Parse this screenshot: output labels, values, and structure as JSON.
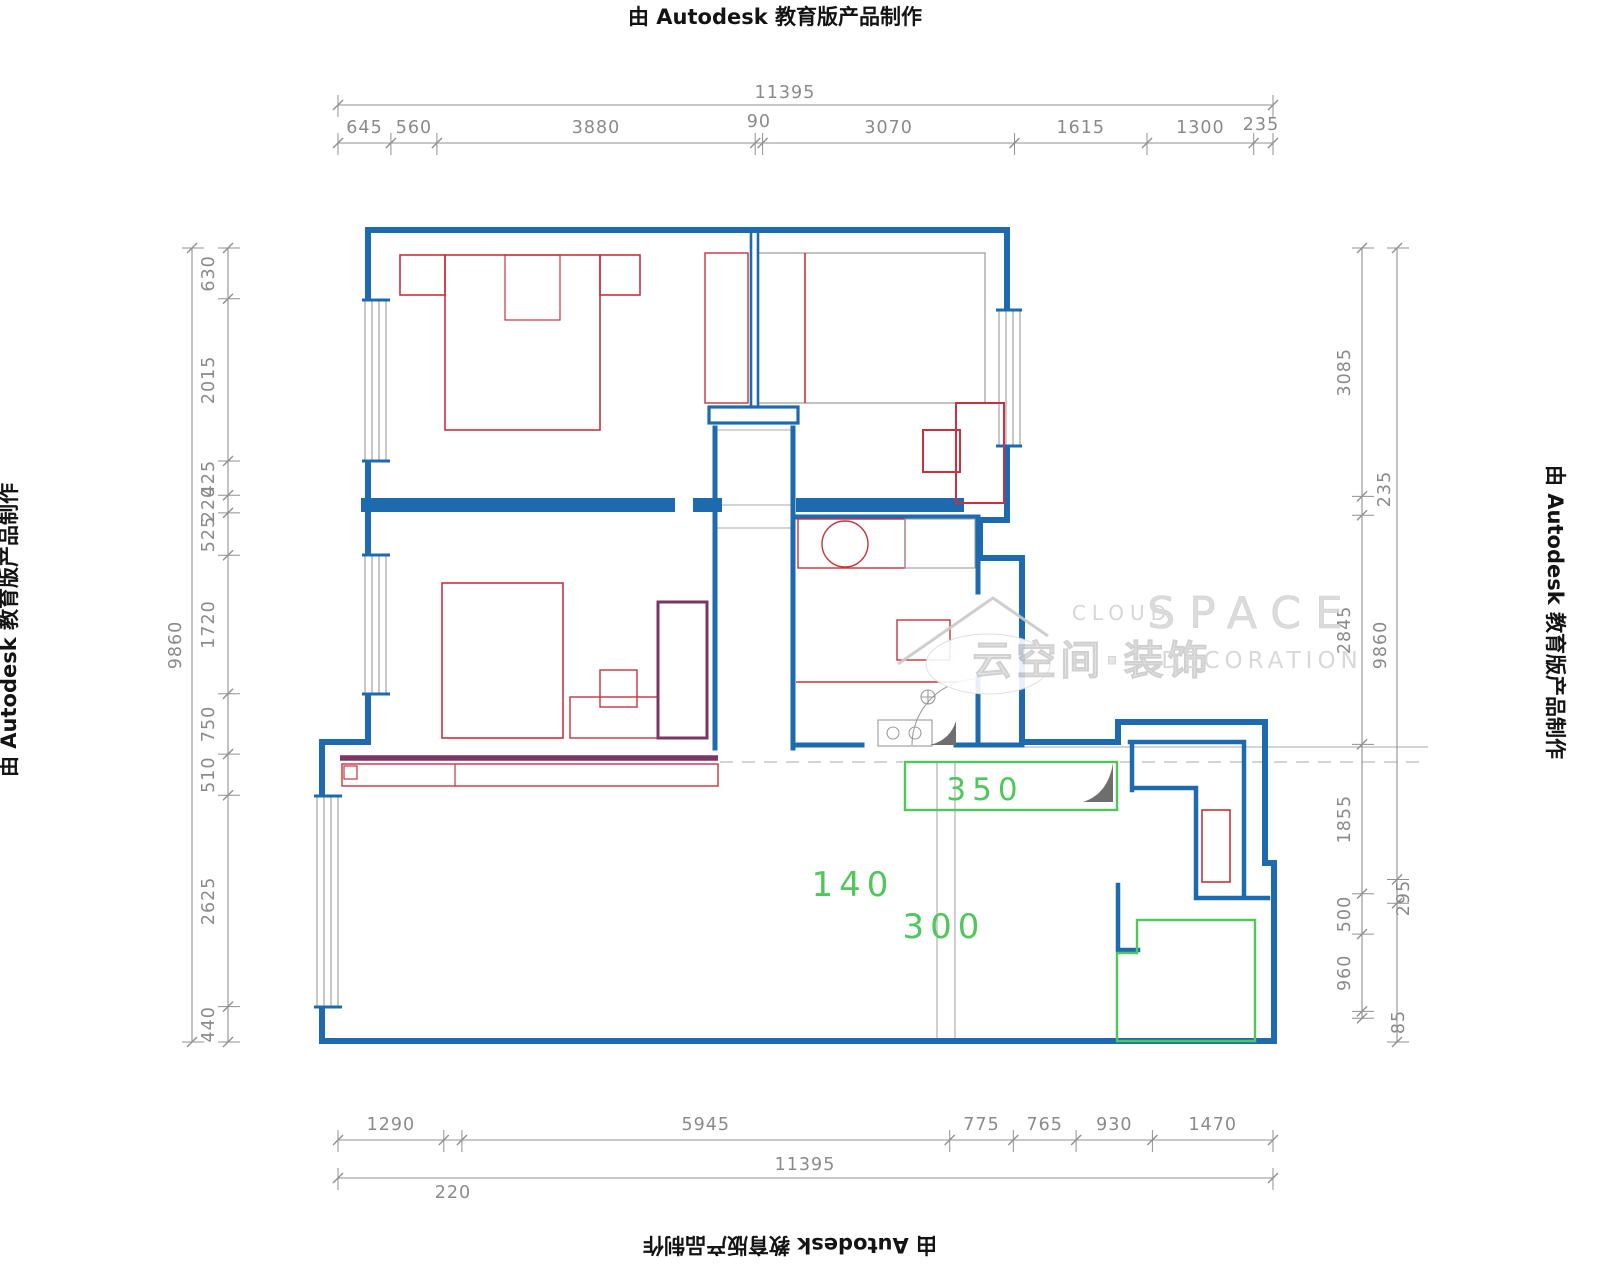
{
  "watermark": {
    "autodesk": "由 Autodesk 教育版产品制作",
    "logo_cloud": "CLOUD",
    "logo_space": "SPACE",
    "logo_cn": "云空间·装饰",
    "logo_decoration": "DECORATION"
  },
  "colors": {
    "wall_blue": "#1d6aae",
    "furniture_red": "#c8323e",
    "wardrobe_purple": "#7d3563",
    "green": "#4fc75a",
    "dim_gray": "#909090",
    "aux_gray": "#a8a8a8",
    "door_fill": "#6e6e6e",
    "watermark_gray": "#d6d6d6"
  },
  "annotations": {
    "green_labels": [
      {
        "t": "350",
        "x": 985,
        "y": 800,
        "size": 31
      },
      {
        "t": "140",
        "x": 853,
        "y": 896,
        "size": 34
      },
      {
        "t": "300",
        "x": 944,
        "y": 938,
        "size": 34
      }
    ]
  },
  "dims": {
    "rows": [
      {
        "name": "top-total-dim",
        "orient": "h",
        "x0": 338,
        "x1": 1273,
        "pos": 105,
        "ticks": [
          338,
          1273
        ],
        "labels": [
          {
            "t": "11395",
            "x": 785,
            "y": 98
          }
        ]
      },
      {
        "name": "top-segments-dim",
        "orient": "h",
        "x0": 338,
        "x1": 1273,
        "pos": 143,
        "ticks": [
          338,
          390.9,
          436.9,
          755.2,
          762.6,
          1014.5,
          1147,
          1253.7,
          1273
        ],
        "labels": [
          {
            "t": "645",
            "x": 364.5,
            "y": 133
          },
          {
            "t": "560",
            "x": 413.9,
            "y": 133
          },
          {
            "t": "3880",
            "x": 596,
            "y": 133
          },
          {
            "t": "90",
            "x": 758.9,
            "y": 127
          },
          {
            "t": "3070",
            "x": 888.6,
            "y": 133
          },
          {
            "t": "1615",
            "x": 1080.8,
            "y": 133
          },
          {
            "t": "1300",
            "x": 1200.4,
            "y": 133
          },
          {
            "t": "235",
            "x": 1261,
            "y": 130
          }
        ]
      },
      {
        "name": "bottom-segments-dim",
        "orient": "h",
        "x0": 338,
        "x1": 1273,
        "pos": 1140,
        "ticks": [
          338,
          443.8,
          461.9,
          949.7,
          1013.3,
          1076.1,
          1152.4,
          1273
        ],
        "labels": [
          {
            "t": "1290",
            "x": 390.9,
            "y": 1130
          },
          {
            "t": "5945",
            "x": 705.8,
            "y": 1130
          },
          {
            "t": "775",
            "x": 981.5,
            "y": 1130
          },
          {
            "t": "765",
            "x": 1044.7,
            "y": 1130
          },
          {
            "t": "930",
            "x": 1114.3,
            "y": 1130
          },
          {
            "t": "1470",
            "x": 1212.7,
            "y": 1130
          },
          {
            "t": "220",
            "x": 452.9,
            "y": 1198
          }
        ]
      },
      {
        "name": "bottom-total-dim",
        "orient": "h",
        "x0": 338,
        "x1": 1273,
        "pos": 1178,
        "ticks": [
          338,
          1273
        ],
        "labels": [
          {
            "t": "11395",
            "x": 805,
            "y": 1170
          }
        ]
      },
      {
        "name": "left-outer-dim",
        "orient": "v",
        "y0": 248,
        "y1": 1042,
        "pos": 192,
        "ticks": [
          248,
          1042
        ],
        "labels": [
          {
            "t": "9860",
            "x": 181,
            "y": 645,
            "rot": -90
          }
        ]
      },
      {
        "name": "left-segments-dim",
        "orient": "v",
        "y0": 248,
        "y1": 1042,
        "pos": 228,
        "ticks": [
          248,
          298.7,
          461,
          495.2,
          512.9,
          555.2,
          693.7,
          754.1,
          795.2,
          1006.6,
          1042
        ],
        "labels": [
          {
            "t": "630",
            "x": 214,
            "y": 273.4,
            "rot": -90
          },
          {
            "t": "2015",
            "x": 214,
            "y": 379.9,
            "rot": -90
          },
          {
            "t": "425",
            "x": 214,
            "y": 478.1,
            "rot": -90
          },
          {
            "t": "220",
            "x": 214,
            "y": 504.1,
            "rot": -90
          },
          {
            "t": "525",
            "x": 214,
            "y": 534.1,
            "rot": -90
          },
          {
            "t": "1720",
            "x": 214,
            "y": 624.5,
            "rot": -90
          },
          {
            "t": "750",
            "x": 214,
            "y": 723.9,
            "rot": -90
          },
          {
            "t": "510",
            "x": 214,
            "y": 774.7,
            "rot": -90
          },
          {
            "t": "2625",
            "x": 214,
            "y": 900.9,
            "rot": -90
          },
          {
            "t": "440",
            "x": 214,
            "y": 1024.3,
            "rot": -90
          }
        ]
      },
      {
        "name": "right-segments-dim",
        "orient": "v",
        "y0": 248,
        "y1": 1018.3,
        "pos": 1362,
        "ticks": [
          248,
          496.4,
          515.3,
          744.4,
          893.8,
          934.1,
          1011.4,
          1018.3
        ],
        "labels": [
          {
            "t": "3085",
            "x": 1350,
            "y": 372.2,
            "rot": -90
          },
          {
            "t": "2845",
            "x": 1350,
            "y": 629.9,
            "rot": -90
          },
          {
            "t": "1855",
            "x": 1350,
            "y": 819.1,
            "rot": -90
          },
          {
            "t": "500",
            "x": 1350,
            "y": 914,
            "rot": -90
          },
          {
            "t": "960",
            "x": 1350,
            "y": 972.8,
            "rot": -90
          },
          {
            "t": "235",
            "x": 1390,
            "y": 489,
            "rot": -90
          },
          {
            "t": "85",
            "x": 1404,
            "y": 1022,
            "rot": -90
          }
        ]
      },
      {
        "name": "right-outer-dim",
        "orient": "v",
        "y0": 248,
        "y1": 1042,
        "pos": 1397,
        "ticks": [
          248,
          879.5,
          903.3,
          1042
        ],
        "labels": [
          {
            "t": "9860",
            "x": 1386,
            "y": 645,
            "rot": -90
          },
          {
            "t": "295",
            "x": 1409,
            "y": 898,
            "rot": -90
          }
        ]
      }
    ]
  }
}
